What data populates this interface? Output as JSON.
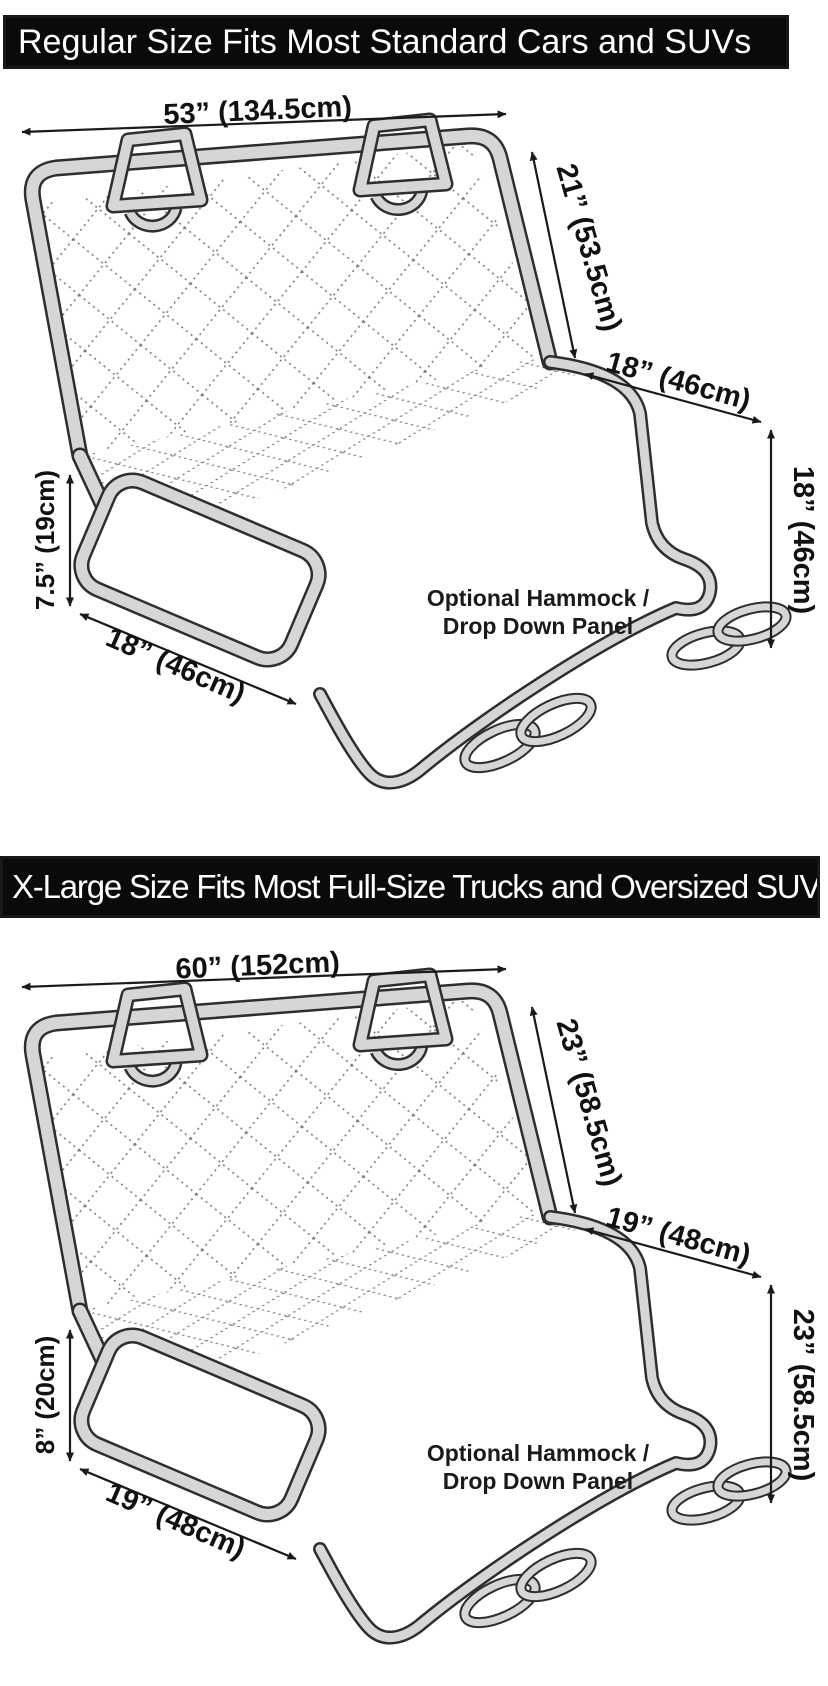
{
  "colors": {
    "banner_bg": "#0a0a0a",
    "banner_text": "#ffffff",
    "band_fill": "#d6d6d6",
    "outline": "#2e2e2e",
    "lattice": "#7a7a7a",
    "label_text": "#111111"
  },
  "sections": [
    {
      "id": "regular",
      "banner": "Regular Size Fits Most Standard Cars and SUVs",
      "dimensions": {
        "top_width": "53” (134.5cm)",
        "backrest_height": "21” (53.5cm)",
        "seat_depth": "18” (46cm)",
        "side_drop": "18” (46cm)",
        "flap_height": "7.5” (19cm)",
        "flap_width": "18” (46cm)"
      },
      "hammock_label_line1": "Optional Hammock /",
      "hammock_label_line2": "Drop Down Panel"
    },
    {
      "id": "xlarge",
      "banner": "X-Large Size Fits Most Full-Size Trucks and Oversized SUVs",
      "dimensions": {
        "top_width": "60” (152cm)",
        "backrest_height": "23” (58.5cm)",
        "seat_depth": "19” (48cm)",
        "side_drop": "23” (58.5cm)",
        "flap_height": "8” (20cm)",
        "flap_width": "19” (48cm)"
      },
      "hammock_label_line1": "Optional Hammock /",
      "hammock_label_line2": "Drop Down Panel"
    }
  ]
}
